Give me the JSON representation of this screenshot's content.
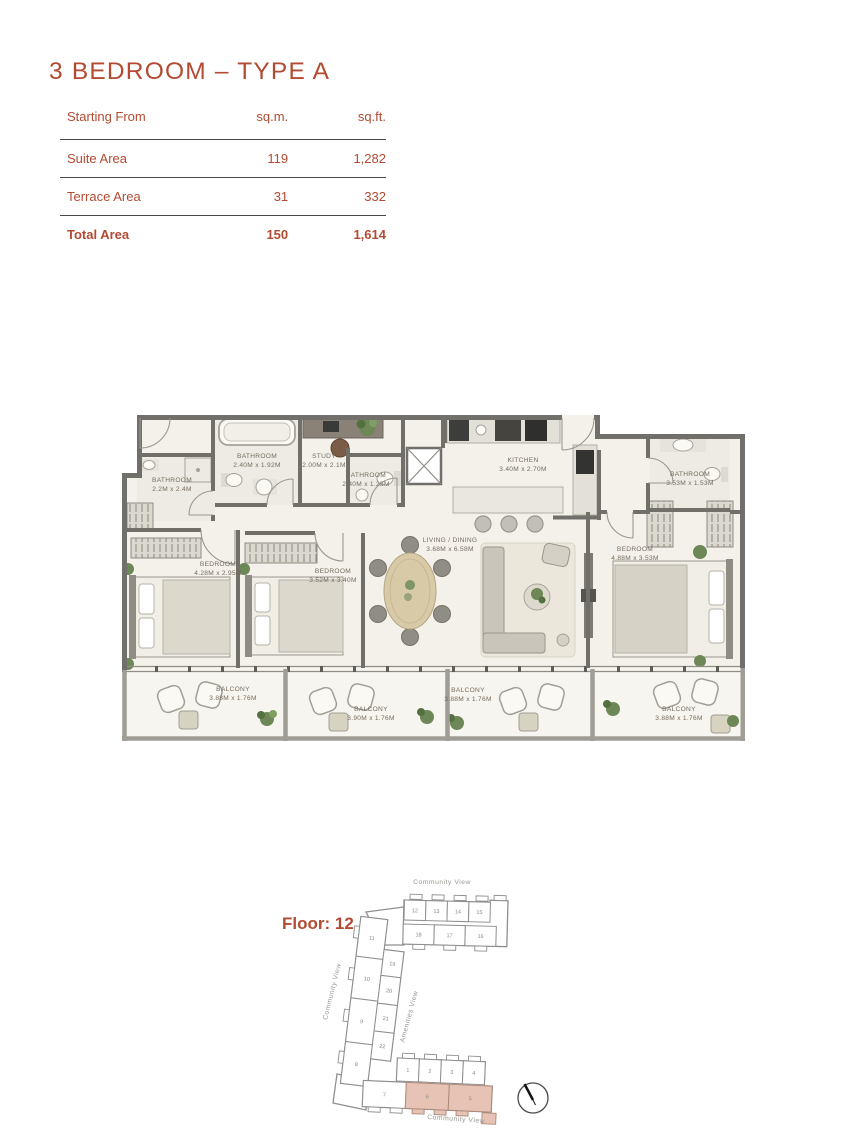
{
  "page": {
    "title": "3 BEDROOM – TYPE A"
  },
  "area_table": {
    "header": {
      "col1": "Starting From",
      "col2": "sq.m.",
      "col3": "sq.ft."
    },
    "rows": [
      {
        "label": "Suite Area",
        "sqm": "119",
        "sqft": "1,282",
        "bold": false
      },
      {
        "label": "Terrace Area",
        "sqm": "31",
        "sqft": "332",
        "bold": false
      },
      {
        "label": "Total Area",
        "sqm": "150",
        "sqft": "1,614",
        "bold": true
      }
    ]
  },
  "floor_plan": {
    "rooms": [
      {
        "label": "BATHROOM",
        "dims": "2.2M x 2.4M",
        "x": 57,
        "y": 82
      },
      {
        "label": "BATHROOM",
        "dims": "2.40M x 1.92M",
        "x": 142,
        "y": 58
      },
      {
        "label": "STUDY",
        "dims": "2.00M x 2.1M",
        "x": 209,
        "y": 58
      },
      {
        "label": "BATHROOM",
        "dims": "2.40M x 1.25M",
        "x": 251,
        "y": 77
      },
      {
        "label": "KITCHEN",
        "dims": "3.40M x 2.70M",
        "x": 408,
        "y": 62
      },
      {
        "label": "BATHROOM",
        "dims": "3.53M x 1.53M",
        "x": 575,
        "y": 76
      },
      {
        "label": "LIVING / DINING",
        "dims": "3.68M x 6.58M",
        "x": 335,
        "y": 142
      },
      {
        "label": "BEDROOM",
        "dims": "4.28M x 2.95M",
        "x": 103,
        "y": 166
      },
      {
        "label": "BEDROOM",
        "dims": "3.52M x 3.40M",
        "x": 218,
        "y": 173
      },
      {
        "label": "BEDROOM",
        "dims": "4.88M x 3.53M",
        "x": 520,
        "y": 151
      },
      {
        "label": "BALCONY",
        "dims": "3.88M x 1.76M",
        "x": 118,
        "y": 291
      },
      {
        "label": "BALCONY",
        "dims": "3.90M x 1.76M",
        "x": 256,
        "y": 311
      },
      {
        "label": "BALCONY",
        "dims": "3.88M x 1.76M",
        "x": 353,
        "y": 292
      },
      {
        "label": "BALCONY",
        "dims": "3.88M x 1.76M",
        "x": 564,
        "y": 311
      }
    ]
  },
  "site_plan": {
    "floor_label": "Floor: 12",
    "views": {
      "top": "Community View",
      "left": "Community View",
      "center": "Amenities View",
      "bottom": "Community View"
    },
    "highlight_color": "#e7c3b5",
    "highlighted_units": [
      "6",
      "5"
    ],
    "wings": [
      {
        "name": "top",
        "units": [
          {
            "n": "12",
            "x": 124.5,
            "y": 30,
            "w": 21.5,
            "h": 20
          },
          {
            "n": "13",
            "x": 146,
            "y": 30,
            "w": 21.5,
            "h": 20
          },
          {
            "n": "14",
            "x": 167.5,
            "y": 30,
            "w": 21.5,
            "h": 20
          },
          {
            "n": "15",
            "x": 189,
            "y": 30,
            "w": 21.5,
            "h": 20
          },
          {
            "n": "18",
            "x": 124,
            "y": 54,
            "w": 31,
            "h": 20
          },
          {
            "n": "17",
            "x": 155,
            "y": 54,
            "w": 31,
            "h": 20
          },
          {
            "n": "16",
            "x": 186,
            "y": 54,
            "w": 31,
            "h": 20
          }
        ]
      },
      {
        "name": "left",
        "units": [
          {
            "n": "11",
            "x": 80,
            "y": 48,
            "w": 27,
            "h": 40
          },
          {
            "n": "10",
            "x": 80,
            "y": 88,
            "w": 27,
            "h": 42
          },
          {
            "n": "9",
            "x": 80,
            "y": 130,
            "w": 27,
            "h": 44
          },
          {
            "n": "8",
            "x": 80,
            "y": 174,
            "w": 27,
            "h": 42
          },
          {
            "n": "19",
            "x": 107,
            "y": 78,
            "w": 20,
            "h": 26
          },
          {
            "n": "20",
            "x": 107,
            "y": 104,
            "w": 20,
            "h": 28
          },
          {
            "n": "21",
            "x": 107,
            "y": 132,
            "w": 20,
            "h": 28
          },
          {
            "n": "22",
            "x": 107,
            "y": 160,
            "w": 20,
            "h": 28
          }
        ]
      },
      {
        "name": "bottom",
        "units": [
          {
            "n": "1",
            "x": 117,
            "y": 188,
            "w": 22,
            "h": 23
          },
          {
            "n": "2",
            "x": 139,
            "y": 188,
            "w": 22,
            "h": 23
          },
          {
            "n": "3",
            "x": 161,
            "y": 188,
            "w": 22,
            "h": 23
          },
          {
            "n": "4",
            "x": 183,
            "y": 188,
            "w": 22,
            "h": 23
          },
          {
            "n": "7",
            "x": 84,
            "y": 212,
            "w": 43,
            "h": 26
          },
          {
            "n": "6",
            "x": 127,
            "y": 212,
            "w": 43,
            "h": 26,
            "hl": true
          },
          {
            "n": "5",
            "x": 170,
            "y": 212,
            "w": 43,
            "h": 26,
            "hl": true
          }
        ]
      }
    ]
  },
  "colors": {
    "accent": "#b34a31",
    "highlight": "#e7c3b5"
  }
}
